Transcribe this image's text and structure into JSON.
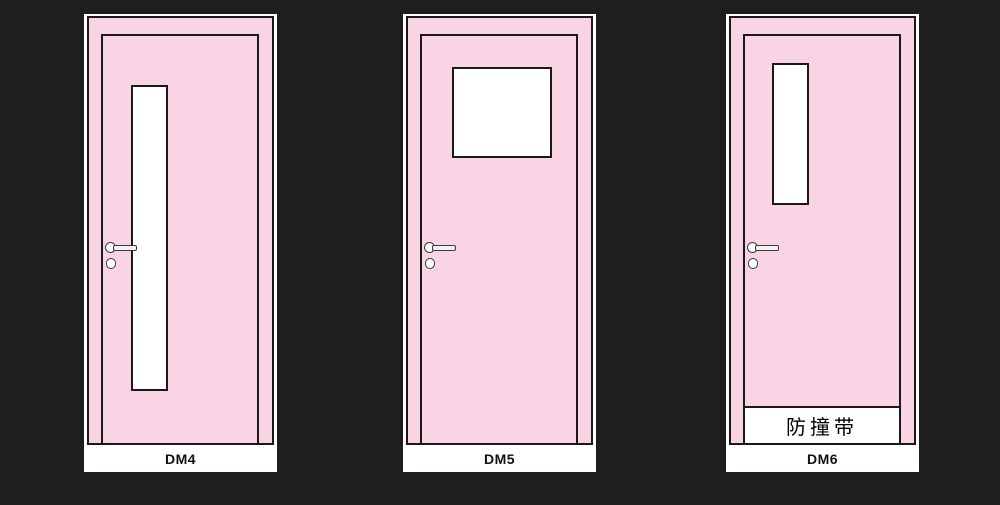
{
  "background_color": "#201d1d",
  "colors": {
    "door_fill": "#f8d4e4",
    "outline": "#1b1918",
    "window_fill": "#ffffff",
    "card_fill": "#ffffff",
    "label_color": "#111111"
  },
  "doors": [
    {
      "label": "DM4"
    },
    {
      "label": "DM5"
    },
    {
      "label": "DM6",
      "bumper_label": "防撞带"
    }
  ]
}
